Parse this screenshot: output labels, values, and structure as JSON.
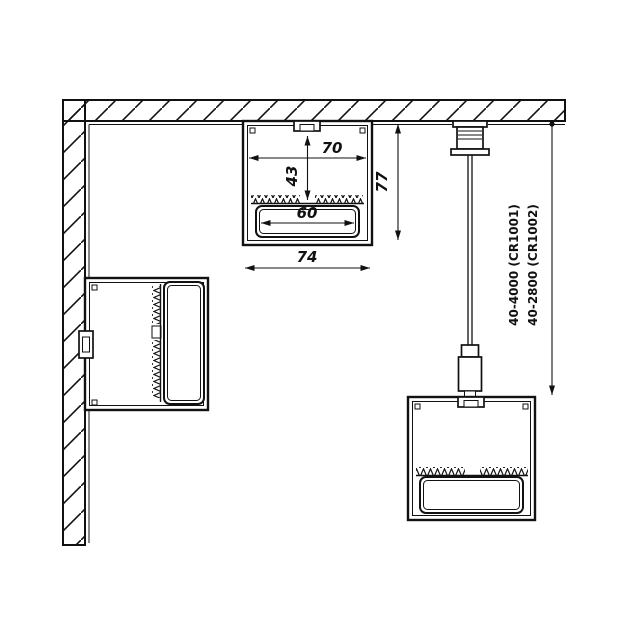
{
  "dims": {
    "inner_width": "70",
    "depth_to_led": "43",
    "lens_width": "60",
    "overall_width": "74",
    "overall_height": "77"
  },
  "suspension": {
    "label_1": "40-4000 (CR1001)",
    "label_2": "40-2800 (CR1002)"
  }
}
